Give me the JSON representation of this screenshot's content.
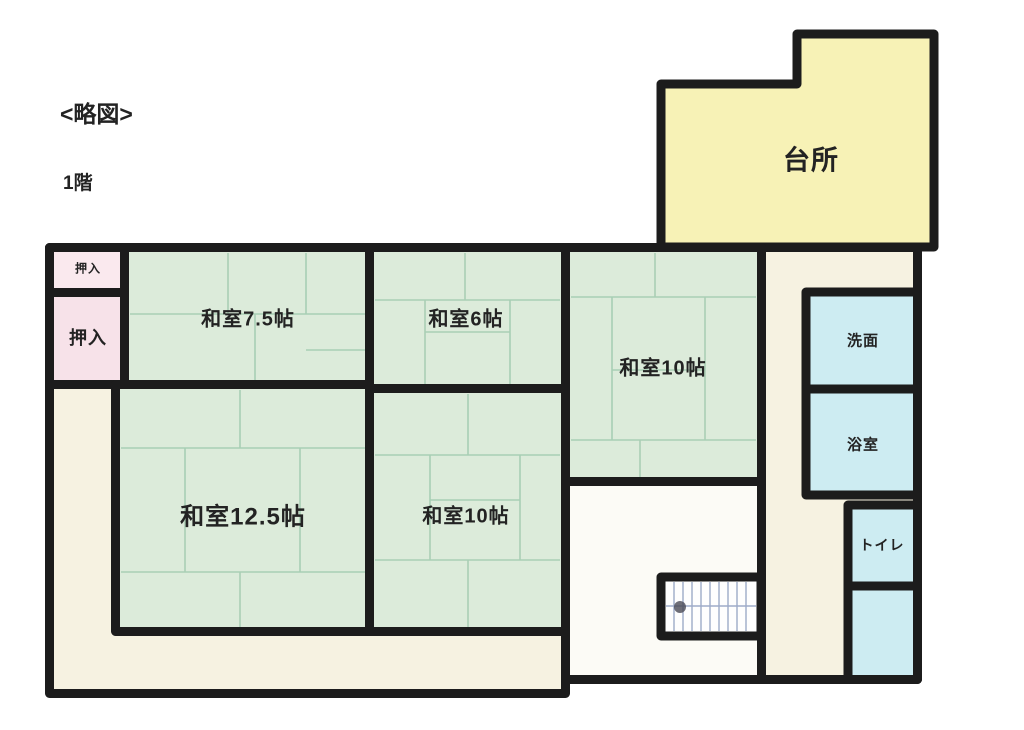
{
  "header": {
    "sketch_label": "<略図>",
    "floor_label": "1階"
  },
  "rooms": {
    "kitchen": {
      "label": "台所",
      "color": "#f7f2b6"
    },
    "closet_top": {
      "label": "押入",
      "color": "#fae9ee"
    },
    "closet_bottom": {
      "label": "押入",
      "color": "#f7e2e9"
    },
    "washitsu_7_5": {
      "label": "和室7.5帖",
      "color": "#dcebda"
    },
    "washitsu_6": {
      "label": "和室6帖",
      "color": "#dcebda"
    },
    "washitsu_10_right": {
      "label": "和室10帖",
      "color": "#dcebda"
    },
    "washitsu_12_5": {
      "label": "和室12.5帖",
      "color": "#dcebda"
    },
    "washitsu_10_center": {
      "label": "和室10帖",
      "color": "#dcebda"
    },
    "washroom": {
      "label": "洗面",
      "color": "#cdecf2"
    },
    "bathroom": {
      "label": "浴室",
      "color": "#cdecf2"
    },
    "toilet": {
      "label": "トイレ",
      "color": "#cdecf2"
    },
    "utility": {
      "color": "#cdecf2"
    },
    "hallway": {
      "color": "#fcfbf6"
    },
    "main_corridor": {
      "color": "#f6f2e1"
    },
    "wing_corridor": {
      "color": "#f6f2e1"
    },
    "staircase": {
      "color": "#fefefe"
    }
  },
  "colors": {
    "wall": "#1c1c1c",
    "background": "#ffffff",
    "tatami_line": "#a6ceb3",
    "stair_line": "#8d9cc0",
    "text": "#232323"
  }
}
